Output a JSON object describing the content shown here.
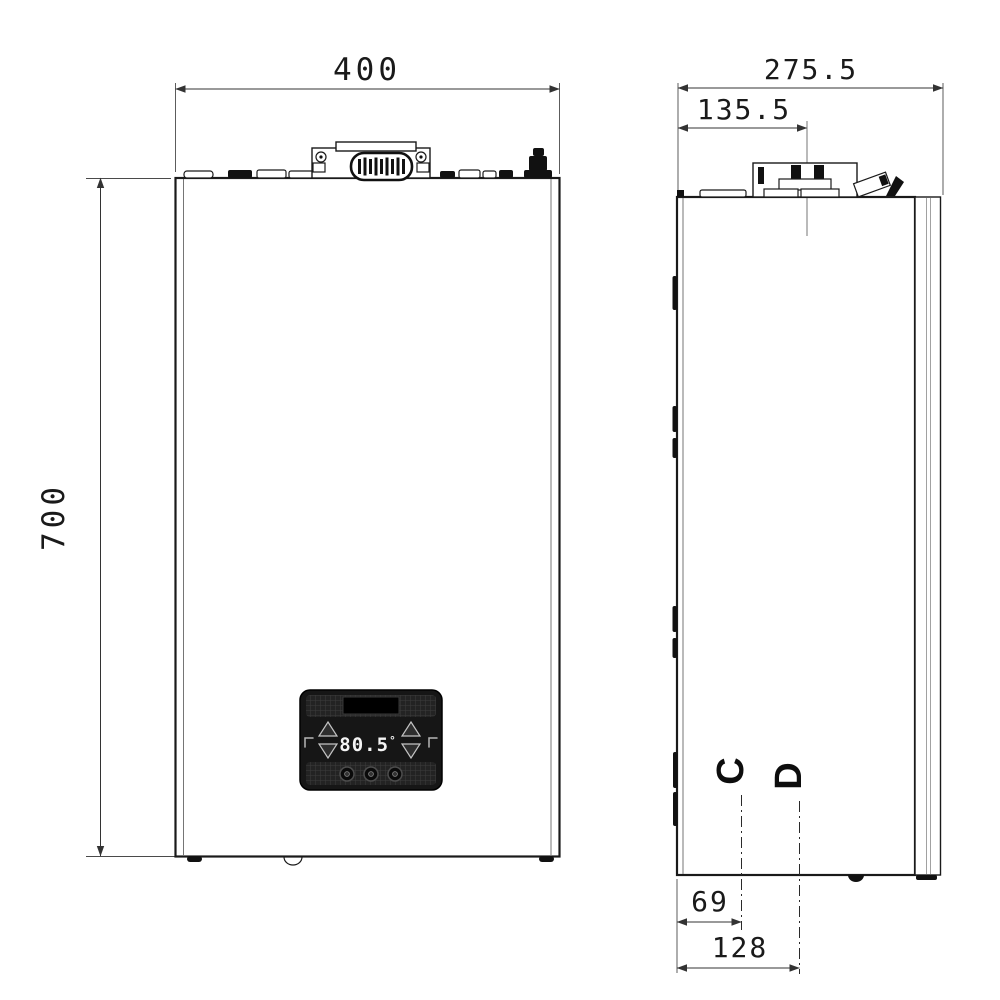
{
  "drawing": {
    "front_view": {
      "width_label": "400",
      "height_label": "700",
      "display": {
        "temperature": "80.5",
        "degree": "°"
      }
    },
    "side_view": {
      "depth_label": "275.5",
      "flue_offset_label": "135.5",
      "connections": [
        {
          "label": "C",
          "offset_label": "69"
        },
        {
          "label": "D",
          "offset_label": "128"
        }
      ]
    },
    "colors": {
      "line": "#1a1a1a",
      "dimension": "#333333",
      "panel": "#161616",
      "background": "#ffffff"
    }
  }
}
